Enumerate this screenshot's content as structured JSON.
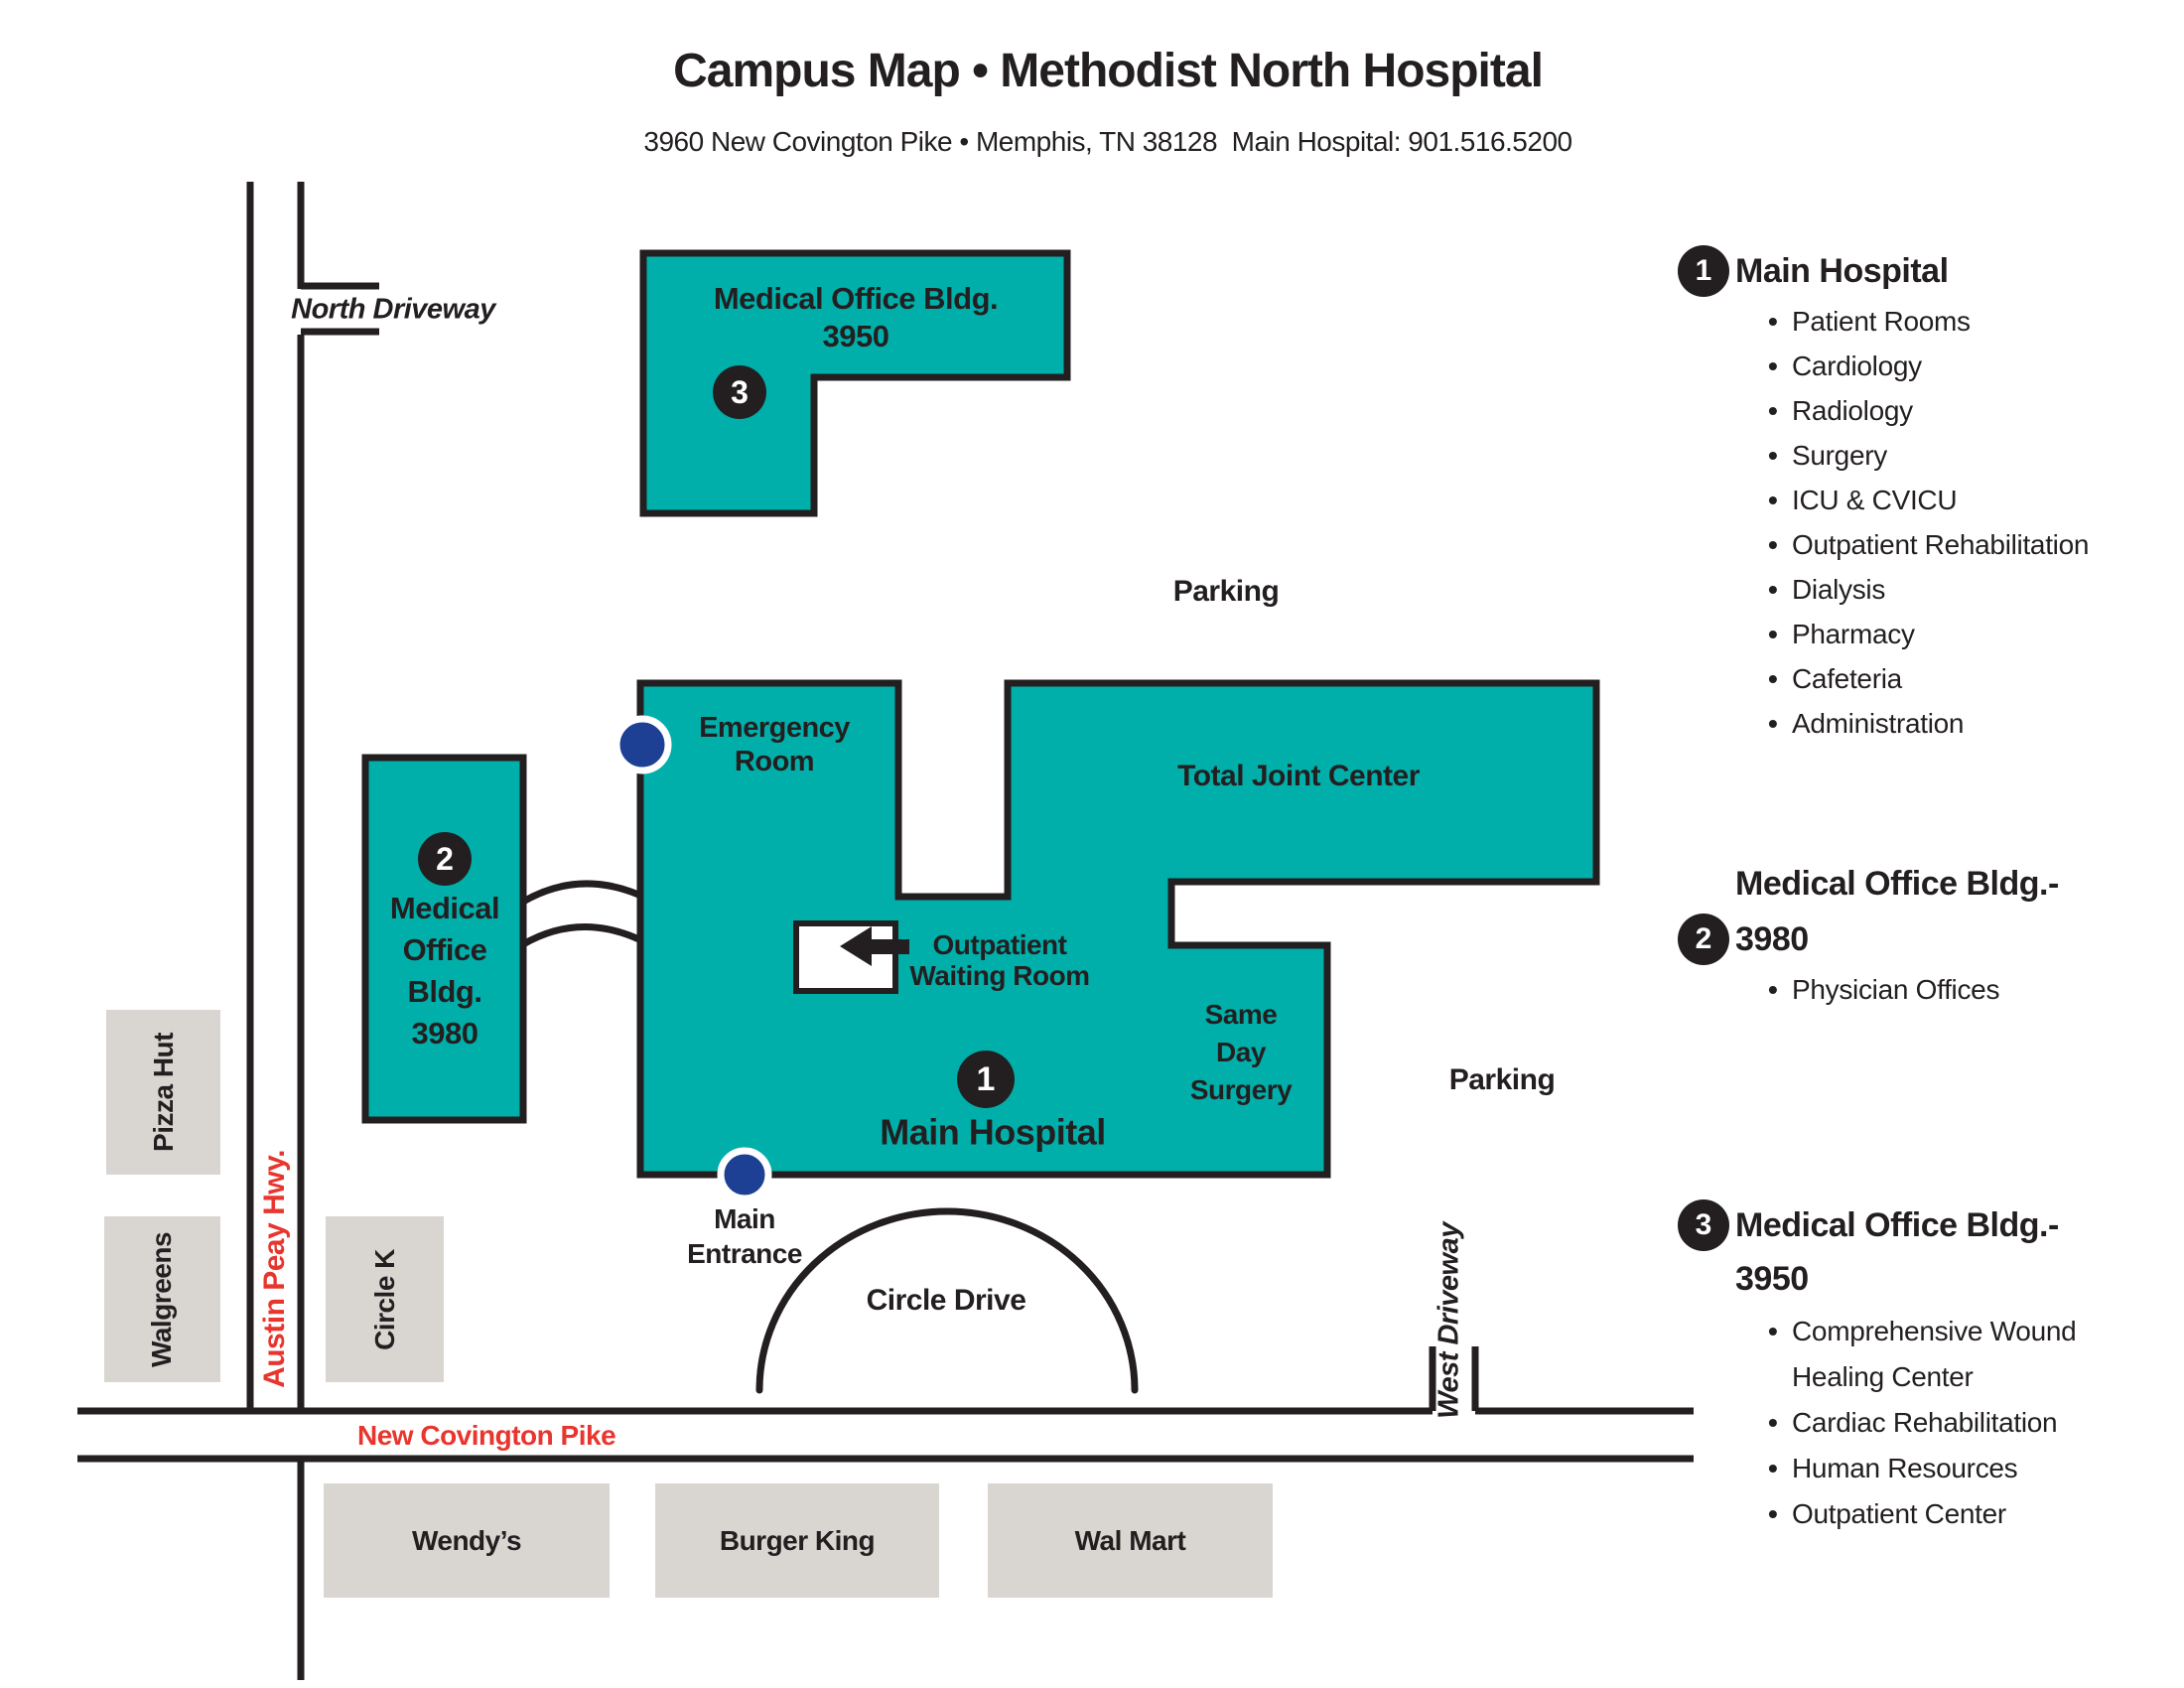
{
  "colors": {
    "teal": "#00AFAA",
    "navy": "#1E4094",
    "red": "#E8352E",
    "gray": "#D9D6D2",
    "ink": "#231F20"
  },
  "header": {
    "title": "Campus Map • Methodist North Hospital",
    "subtitle": "3960 New Covington Pike • Memphis, TN 38128  Main Hospital: 901.516.5200"
  },
  "map": {
    "roads": {
      "north_driveway": "North Driveway",
      "austin_peay": "Austin Peay Hwy.",
      "new_covington_pike": "New Covington Pike",
      "west_driveway": "West Driveway",
      "circle_drive": "Circle Drive"
    },
    "parking_north": "Parking",
    "parking_east": "Parking",
    "main_entrance": [
      "Main",
      "Entrance"
    ],
    "buildings": {
      "mob3950": {
        "badge": "3",
        "line1": "Medical Office Bldg.",
        "line2": "3950"
      },
      "mob3980": {
        "badge": "2",
        "lines": [
          "Medical",
          "Office",
          "Bldg.",
          "3980"
        ]
      },
      "hospital": {
        "badge": "1",
        "label": "Main Hospital",
        "emergency": [
          "Emergency",
          "Room"
        ],
        "total_joint": "Total Joint Center",
        "same_day": [
          "Same",
          "Day",
          "Surgery"
        ],
        "outpatient": [
          "Outpatient",
          "Waiting Room"
        ]
      }
    },
    "businesses": {
      "pizza_hut": "Pizza Hut",
      "walgreens": "Walgreens",
      "circle_k": "Circle K",
      "wendys": "Wendy’s",
      "burger_king": "Burger King",
      "wal_mart": "Wal Mart"
    }
  },
  "legend": [
    {
      "badge": "1",
      "title": "Main Hospital",
      "subtitle": "",
      "items": [
        "Patient Rooms",
        "Cardiology",
        "Radiology",
        "Surgery",
        "ICU & CVICU",
        "Outpatient Rehabilitation",
        "Dialysis",
        "Pharmacy",
        "Cafeteria",
        "Administration"
      ]
    },
    {
      "badge": "2",
      "title": "Medical Office Bldg.-",
      "subtitle": "3980",
      "items": [
        "Physician Offices"
      ]
    },
    {
      "badge": "3",
      "title": "Medical Office Bldg.-",
      "subtitle": "3950",
      "items": [
        "Comprehensive Wound Healing Center",
        "Cardiac Rehabilitation",
        "Human Resources",
        "Outpatient Center"
      ]
    }
  ]
}
